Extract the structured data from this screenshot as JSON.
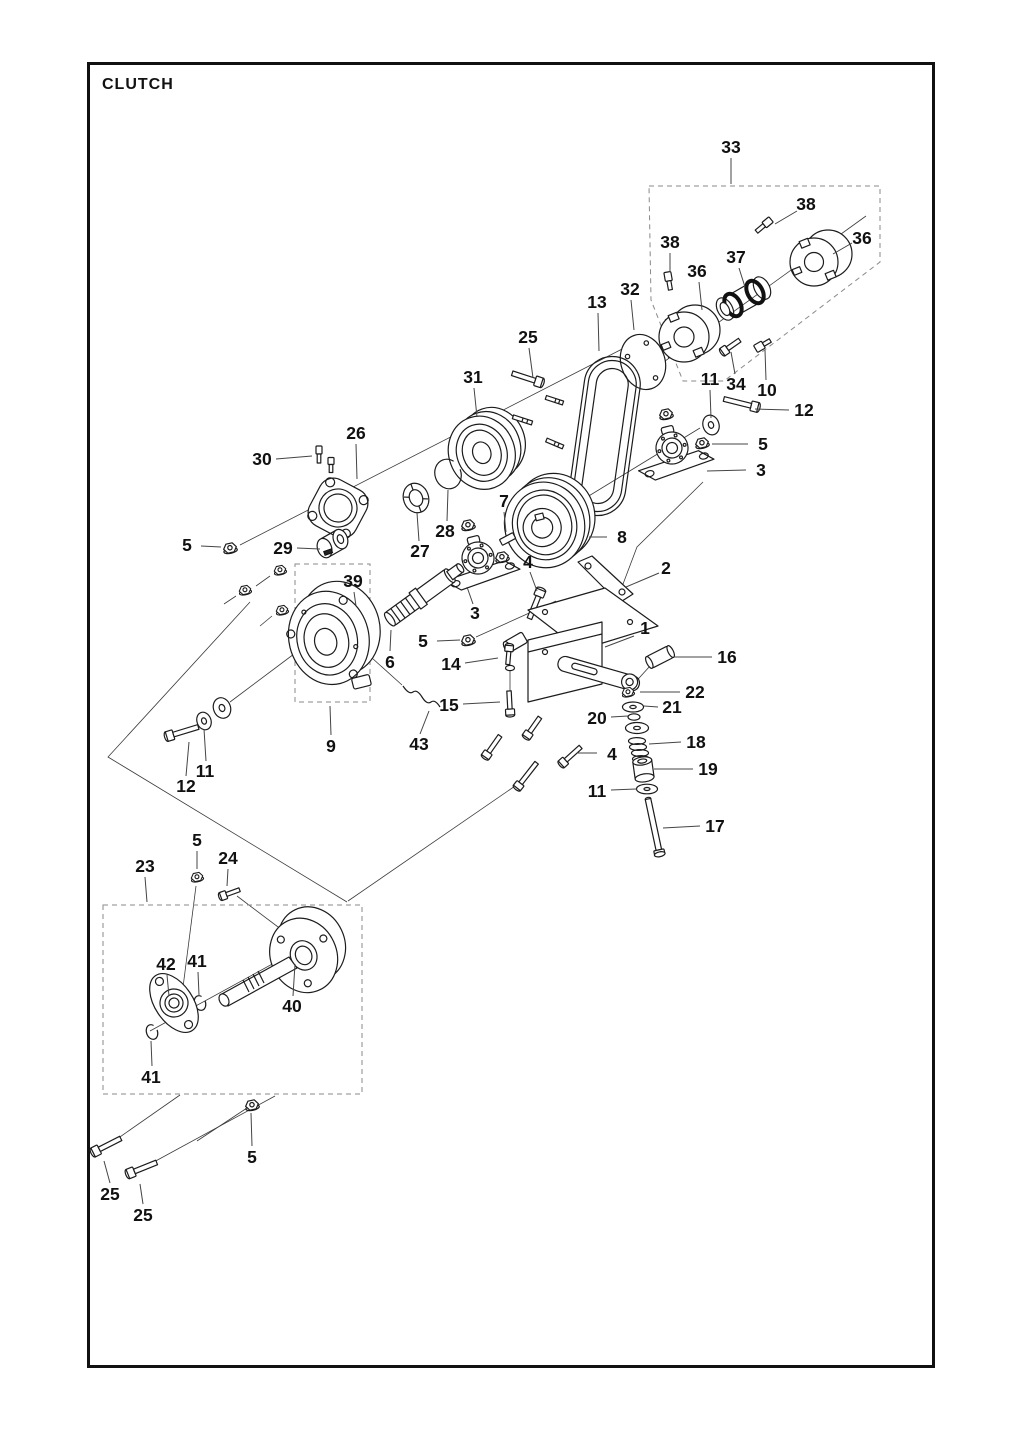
{
  "title": "CLUTCH",
  "colors": {
    "ink": "#1c1c1c",
    "dash_box": "#8a8a8a",
    "background": "#ffffff"
  },
  "callouts": [
    {
      "label": "33",
      "x": 731,
      "y": 147,
      "lx1": 731,
      "ly1": 158,
      "lx2": 731,
      "ly2": 184
    },
    {
      "label": "38",
      "x": 670,
      "y": 242,
      "lx1": 670,
      "ly1": 253,
      "lx2": 670,
      "ly2": 272
    },
    {
      "label": "38",
      "x": 806,
      "y": 204,
      "lx1": 797,
      "ly1": 211,
      "lx2": 775,
      "ly2": 224
    },
    {
      "label": "36",
      "x": 697,
      "y": 271,
      "lx1": 699,
      "ly1": 282,
      "lx2": 702,
      "ly2": 310
    },
    {
      "label": "36",
      "x": 862,
      "y": 238,
      "lx1": 852,
      "ly1": 243,
      "lx2": 833,
      "ly2": 254
    },
    {
      "label": "37",
      "x": 736,
      "y": 257,
      "lx1": 739,
      "ly1": 268,
      "lx2": 745,
      "ly2": 287
    },
    {
      "label": "13",
      "x": 597,
      "y": 302,
      "lx1": 598,
      "ly1": 313,
      "lx2": 599,
      "ly2": 351
    },
    {
      "label": "32",
      "x": 630,
      "y": 289,
      "lx1": 631,
      "ly1": 300,
      "lx2": 634,
      "ly2": 330
    },
    {
      "label": "25",
      "x": 528,
      "y": 337,
      "lx1": 529,
      "ly1": 348,
      "lx2": 533,
      "ly2": 378
    },
    {
      "label": "31",
      "x": 473,
      "y": 377,
      "lx1": 474,
      "ly1": 388,
      "lx2": 477,
      "ly2": 417
    },
    {
      "label": "26",
      "x": 356,
      "y": 433,
      "lx1": 356,
      "ly1": 444,
      "lx2": 357,
      "ly2": 479
    },
    {
      "label": "30",
      "x": 262,
      "y": 459,
      "lx1": 276,
      "ly1": 459,
      "lx2": 312,
      "ly2": 456
    },
    {
      "label": "11",
      "x": 710,
      "y": 379,
      "lx1": 710,
      "ly1": 390,
      "lx2": 711,
      "ly2": 418
    },
    {
      "label": "34",
      "x": 736,
      "y": 384,
      "lx1": 735,
      "ly1": 374,
      "lx2": 731,
      "ly2": 352
    },
    {
      "label": "10",
      "x": 767,
      "y": 390,
      "lx1": 766,
      "ly1": 380,
      "lx2": 765,
      "ly2": 350
    },
    {
      "label": "12",
      "x": 804,
      "y": 410,
      "lx1": 789,
      "ly1": 410,
      "lx2": 755,
      "ly2": 409
    },
    {
      "label": "5",
      "x": 763,
      "y": 444,
      "lx1": 748,
      "ly1": 444,
      "lx2": 712,
      "ly2": 444
    },
    {
      "label": "3",
      "x": 761,
      "y": 470,
      "lx1": 746,
      "ly1": 470,
      "lx2": 707,
      "ly2": 471
    },
    {
      "label": "7",
      "x": 504,
      "y": 501,
      "lx1": 504,
      "ly1": 512,
      "lx2": 506,
      "ly2": 532
    },
    {
      "label": "8",
      "x": 622,
      "y": 537,
      "lx1": 607,
      "ly1": 537,
      "lx2": 589,
      "ly2": 537
    },
    {
      "label": "28",
      "x": 445,
      "y": 531,
      "lx1": 447,
      "ly1": 521,
      "lx2": 448,
      "ly2": 490
    },
    {
      "label": "27",
      "x": 420,
      "y": 551,
      "lx1": 419,
      "ly1": 541,
      "lx2": 417,
      "ly2": 513
    },
    {
      "label": "5",
      "x": 187,
      "y": 545,
      "lx1": 201,
      "ly1": 546,
      "lx2": 221,
      "ly2": 547
    },
    {
      "label": "29",
      "x": 283,
      "y": 548,
      "lx1": 297,
      "ly1": 548,
      "lx2": 320,
      "ly2": 549
    },
    {
      "label": "39",
      "x": 353,
      "y": 581,
      "lx1": 354,
      "ly1": 592,
      "lx2": 356,
      "ly2": 606
    },
    {
      "label": "2",
      "x": 666,
      "y": 568,
      "lx1": 659,
      "ly1": 573,
      "lx2": 626,
      "ly2": 587
    },
    {
      "label": "4",
      "x": 528,
      "y": 562,
      "lx1": 530,
      "ly1": 572,
      "lx2": 537,
      "ly2": 591
    },
    {
      "label": "3",
      "x": 475,
      "y": 613,
      "lx1": 473,
      "ly1": 604,
      "lx2": 467,
      "ly2": 587
    },
    {
      "label": "1",
      "x": 645,
      "y": 628,
      "lx1": 634,
      "ly1": 636,
      "lx2": 605,
      "ly2": 647
    },
    {
      "label": "5",
      "x": 423,
      "y": 641,
      "lx1": 437,
      "ly1": 641,
      "lx2": 460,
      "ly2": 640
    },
    {
      "label": "6",
      "x": 390,
      "y": 662,
      "lx1": 390,
      "ly1": 651,
      "lx2": 391,
      "ly2": 630
    },
    {
      "label": "14",
      "x": 451,
      "y": 664,
      "lx1": 465,
      "ly1": 663,
      "lx2": 498,
      "ly2": 658
    },
    {
      "label": "16",
      "x": 727,
      "y": 657,
      "lx1": 712,
      "ly1": 657,
      "lx2": 674,
      "ly2": 657
    },
    {
      "label": "22",
      "x": 695,
      "y": 692,
      "lx1": 680,
      "ly1": 692,
      "lx2": 640,
      "ly2": 692
    },
    {
      "label": "21",
      "x": 672,
      "y": 707,
      "lx1": 658,
      "ly1": 707,
      "lx2": 644,
      "ly2": 706
    },
    {
      "label": "20",
      "x": 597,
      "y": 718,
      "lx1": 611,
      "ly1": 717,
      "lx2": 628,
      "ly2": 716
    },
    {
      "label": "15",
      "x": 449,
      "y": 705,
      "lx1": 463,
      "ly1": 704,
      "lx2": 500,
      "ly2": 702
    },
    {
      "label": "18",
      "x": 696,
      "y": 742,
      "lx1": 681,
      "ly1": 742,
      "lx2": 649,
      "ly2": 744
    },
    {
      "label": "43",
      "x": 419,
      "y": 744,
      "lx1": 420,
      "ly1": 734,
      "lx2": 429,
      "ly2": 711
    },
    {
      "label": "9",
      "x": 331,
      "y": 746,
      "lx1": 331,
      "ly1": 735,
      "lx2": 330,
      "ly2": 706
    },
    {
      "label": "4",
      "x": 612,
      "y": 754,
      "lx1": 597,
      "ly1": 753,
      "lx2": 577,
      "ly2": 753
    },
    {
      "label": "19",
      "x": 708,
      "y": 769,
      "lx1": 693,
      "ly1": 769,
      "lx2": 654,
      "ly2": 769
    },
    {
      "label": "11",
      "x": 597,
      "y": 791,
      "lx1": 611,
      "ly1": 790,
      "lx2": 637,
      "ly2": 789
    },
    {
      "label": "11",
      "x": 205,
      "y": 771,
      "lx1": 206,
      "ly1": 761,
      "lx2": 204,
      "ly2": 729
    },
    {
      "label": "12",
      "x": 186,
      "y": 786,
      "lx1": 186,
      "ly1": 776,
      "lx2": 189,
      "ly2": 742
    },
    {
      "label": "17",
      "x": 715,
      "y": 826,
      "lx1": 700,
      "ly1": 826,
      "lx2": 663,
      "ly2": 828
    },
    {
      "label": "5",
      "x": 197,
      "y": 840,
      "lx1": 197,
      "ly1": 851,
      "lx2": 197,
      "ly2": 869
    },
    {
      "label": "23",
      "x": 145,
      "y": 866,
      "lx1": 145,
      "ly1": 877,
      "lx2": 147,
      "ly2": 902
    },
    {
      "label": "24",
      "x": 228,
      "y": 858,
      "lx1": 228,
      "ly1": 869,
      "lx2": 227,
      "ly2": 886
    },
    {
      "label": "42",
      "x": 166,
      "y": 964,
      "lx1": 167,
      "ly1": 975,
      "lx2": 169,
      "ly2": 996
    },
    {
      "label": "41",
      "x": 197,
      "y": 961,
      "lx1": 198,
      "ly1": 972,
      "lx2": 199,
      "ly2": 995
    },
    {
      "label": "40",
      "x": 292,
      "y": 1006,
      "lx1": 293,
      "ly1": 996,
      "lx2": 295,
      "ly2": 964
    },
    {
      "label": "41",
      "x": 151,
      "y": 1077,
      "lx1": 152,
      "ly1": 1066,
      "lx2": 151,
      "ly2": 1041
    },
    {
      "label": "5",
      "x": 252,
      "y": 1157,
      "lx1": 252,
      "ly1": 1146,
      "lx2": 251,
      "ly2": 1113
    },
    {
      "label": "25",
      "x": 110,
      "y": 1194,
      "lx1": 110,
      "ly1": 1183,
      "lx2": 104,
      "ly2": 1161
    },
    {
      "label": "25",
      "x": 143,
      "y": 1215,
      "lx1": 143,
      "ly1": 1204,
      "lx2": 140,
      "ly2": 1184
    }
  ]
}
